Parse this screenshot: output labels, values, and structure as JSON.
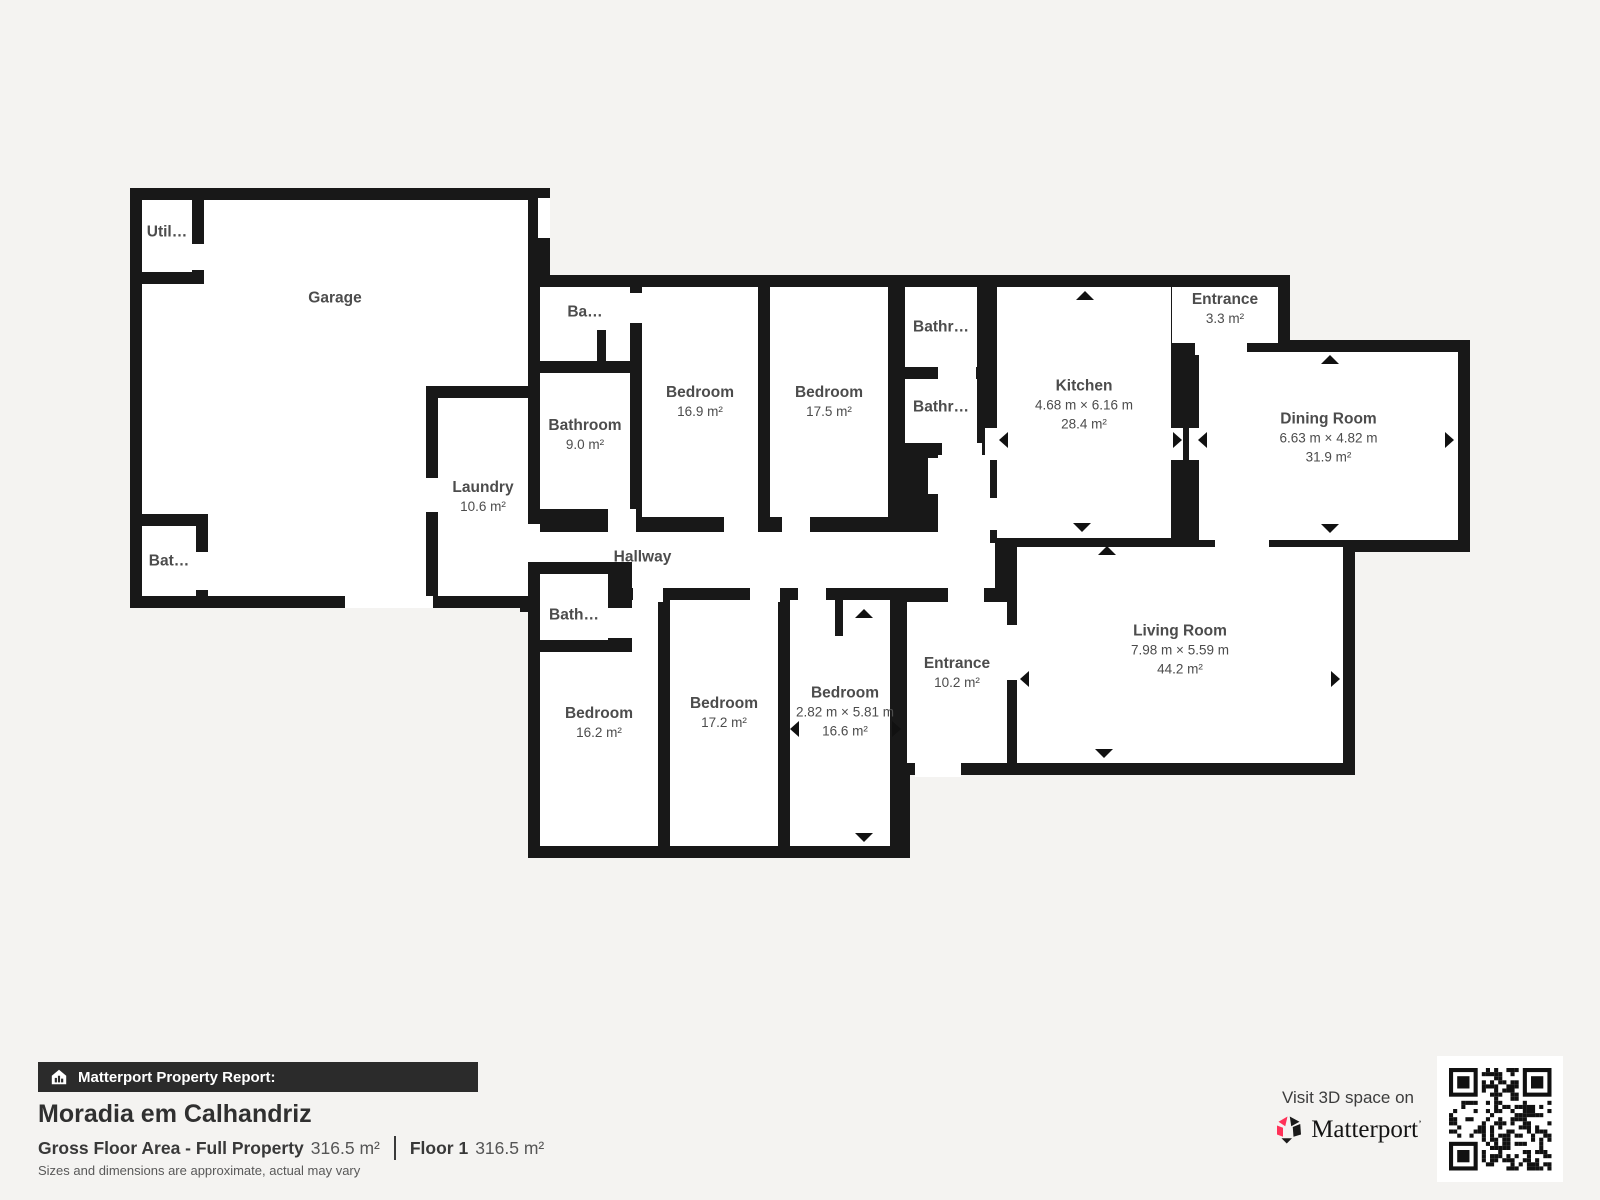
{
  "report": {
    "banner": "Matterport Property Report:",
    "property_name": "Moradia em Calhandriz",
    "gross_label": "Gross Floor Area - Full Property",
    "gross_value": "316.5 m²",
    "floor_label": "Floor 1",
    "floor_value": "316.5 m²",
    "disclaimer": "Sizes and dimensions are approximate, actual may vary"
  },
  "promo": {
    "visit_text": "Visit 3D space on",
    "brand": "Matterport",
    "trademark": "’"
  },
  "colors": {
    "wall": "#181818",
    "background": "#f4f3f1",
    "room": "#ffffff",
    "label": "#4c4c4c",
    "brand_red": "#ff3158",
    "banner_bg": "#2b2b2b"
  },
  "floorplan": {
    "cells": [
      {
        "t": "wall",
        "x": 130,
        "y": 188,
        "w": 420,
        "h": 420
      },
      {
        "t": "wall",
        "x": 528,
        "y": 275,
        "w": 382,
        "h": 270
      },
      {
        "t": "wall",
        "x": 893,
        "y": 275,
        "w": 92,
        "h": 180
      },
      {
        "t": "wall",
        "x": 893,
        "y": 443,
        "w": 100,
        "h": 100
      },
      {
        "t": "wall",
        "x": 985,
        "y": 275,
        "w": 200,
        "h": 275
      },
      {
        "t": "wall",
        "x": 1160,
        "y": 275,
        "w": 130,
        "h": 80
      },
      {
        "t": "wall",
        "x": 1181,
        "y": 350,
        "w": 20,
        "h": 202
      },
      {
        "t": "wall",
        "x": 1185,
        "y": 340,
        "w": 285,
        "h": 212
      },
      {
        "t": "wall",
        "x": 995,
        "y": 532,
        "w": 22,
        "h": 80
      },
      {
        "t": "wall",
        "x": 1005,
        "y": 535,
        "w": 350,
        "h": 240
      },
      {
        "t": "wall",
        "x": 895,
        "y": 590,
        "w": 130,
        "h": 185
      },
      {
        "t": "wall",
        "x": 520,
        "y": 520,
        "w": 475,
        "h": 92
      },
      {
        "t": "wall",
        "x": 528,
        "y": 588,
        "w": 382,
        "h": 270
      },
      {
        "t": "room",
        "x": 142,
        "y": 200,
        "w": 386,
        "h": 396,
        "label": {
          "name": "Garage",
          "dy": -100
        }
      },
      {
        "t": "wall",
        "x": 130,
        "y": 188,
        "w": 74,
        "h": 96
      },
      {
        "t": "room",
        "x": 142,
        "y": 200,
        "w": 50,
        "h": 72,
        "label": {
          "name": "Util…",
          "dy": -4
        }
      },
      {
        "t": "wall",
        "x": 130,
        "y": 514,
        "w": 78,
        "h": 94
      },
      {
        "t": "room",
        "x": 142,
        "y": 526,
        "w": 54,
        "h": 70,
        "label": {
          "name": "Bat…"
        }
      },
      {
        "t": "wall",
        "x": 426,
        "y": 386,
        "w": 114,
        "h": 222
      },
      {
        "t": "room",
        "x": 438,
        "y": 398,
        "w": 90,
        "h": 198,
        "label": {
          "name": "Laundry",
          "area": "10.6 m²"
        }
      },
      {
        "t": "room",
        "x": 540,
        "y": 287,
        "w": 90,
        "h": 74,
        "label": {
          "name": "Ba…",
          "dy": -12
        }
      },
      {
        "t": "wall",
        "x": 597,
        "y": 330,
        "w": 9,
        "h": 31
      },
      {
        "t": "room",
        "x": 540,
        "y": 373,
        "w": 90,
        "h": 136,
        "label": {
          "name": "Bathroom",
          "area": "9.0 m²",
          "dy": -6
        }
      },
      {
        "t": "room",
        "x": 642,
        "y": 287,
        "w": 116,
        "h": 230,
        "label": {
          "name": "Bedroom",
          "area": "16.9 m²"
        }
      },
      {
        "t": "room",
        "x": 770,
        "y": 287,
        "w": 118,
        "h": 230,
        "label": {
          "name": "Bedroom",
          "area": "17.5 m²"
        }
      },
      {
        "t": "room",
        "x": 905,
        "y": 287,
        "w": 72,
        "h": 80,
        "label": {
          "name": "Bathr…"
        }
      },
      {
        "t": "room",
        "x": 905,
        "y": 379,
        "w": 72,
        "h": 64,
        "label": {
          "name": "Bathr…",
          "dy": -4
        }
      },
      {
        "t": "room",
        "x": 938,
        "y": 455,
        "w": 52,
        "h": 88
      },
      {
        "t": "room",
        "x": 997,
        "y": 287,
        "w": 174,
        "h": 251,
        "label": {
          "name": "Kitchen",
          "dims": "4.68 m × 6.16 m",
          "area": "28.4 m²",
          "dy": -8
        }
      },
      {
        "t": "room",
        "x": 1172,
        "y": 287,
        "w": 106,
        "h": 56,
        "label": {
          "name": "Entrance",
          "area": "3.3 m²",
          "dy": -6
        }
      },
      {
        "t": "room",
        "x": 1199,
        "y": 352,
        "w": 259,
        "h": 188,
        "label": {
          "name": "Dining Room",
          "dims": "6.63 m × 4.82 m",
          "area": "31.9 m²",
          "dy": -8
        }
      },
      {
        "t": "room",
        "x": 1017,
        "y": 547,
        "w": 326,
        "h": 216,
        "label": {
          "name": "Living Room",
          "dims": "7.98 m × 5.59 m",
          "area": "44.2 m²",
          "dy": -5
        }
      },
      {
        "t": "room",
        "x": 540,
        "y": 532,
        "w": 437,
        "h": 56,
        "label": {
          "name": "Hallway",
          "dx": -116,
          "dy": -3
        }
      },
      {
        "t": "room",
        "x": 935,
        "y": 543,
        "w": 60,
        "h": 45
      },
      {
        "t": "room",
        "x": 540,
        "y": 600,
        "w": 118,
        "h": 246,
        "label": {
          "name": "Bedroom",
          "area": "16.2 m²"
        }
      },
      {
        "t": "room",
        "x": 670,
        "y": 600,
        "w": 108,
        "h": 246,
        "label": {
          "name": "Bedroom",
          "area": "17.2 m²",
          "dy": -10
        }
      },
      {
        "t": "room",
        "x": 790,
        "y": 600,
        "w": 100,
        "h": 246,
        "label": {
          "name": "Bedroom",
          "dims": "2.82 m × 5.81 m",
          "area": "16.6 m²",
          "dx": 5,
          "dy": -11
        }
      },
      {
        "t": "wall",
        "x": 835,
        "y": 600,
        "w": 8,
        "h": 36
      },
      {
        "t": "room",
        "x": 907,
        "y": 602,
        "w": 100,
        "h": 161,
        "label": {
          "name": "Entrance",
          "area": "10.2 m²",
          "dy": -10
        }
      },
      {
        "t": "wall",
        "x": 528,
        "y": 562,
        "w": 104,
        "h": 90
      },
      {
        "t": "room",
        "x": 540,
        "y": 574,
        "w": 68,
        "h": 66,
        "label": {
          "name": "Bath…",
          "dy": 8
        }
      }
    ],
    "openings": [
      [
        192,
        244,
        12,
        26
      ],
      [
        538,
        198,
        12,
        40
      ],
      [
        196,
        552,
        12,
        38
      ],
      [
        426,
        478,
        12,
        34
      ],
      [
        345,
        596,
        88,
        12
      ],
      [
        528,
        524,
        12,
        38
      ],
      [
        630,
        293,
        12,
        30
      ],
      [
        608,
        509,
        28,
        24
      ],
      [
        724,
        517,
        34,
        17
      ],
      [
        782,
        517,
        28,
        17
      ],
      [
        938,
        367,
        38,
        12
      ],
      [
        942,
        443,
        40,
        12
      ],
      [
        928,
        458,
        12,
        36
      ],
      [
        985,
        428,
        12,
        32
      ],
      [
        985,
        498,
        12,
        32
      ],
      [
        1171,
        428,
        12,
        32
      ],
      [
        1189,
        428,
        12,
        32
      ],
      [
        1195,
        343,
        52,
        12
      ],
      [
        1215,
        536,
        54,
        18
      ],
      [
        1007,
        625,
        10,
        55
      ],
      [
        948,
        584,
        36,
        20
      ],
      [
        915,
        763,
        46,
        14
      ],
      [
        633,
        584,
        30,
        18
      ],
      [
        750,
        584,
        30,
        18
      ],
      [
        798,
        584,
        28,
        18
      ],
      [
        608,
        608,
        26,
        30
      ]
    ],
    "arrows": [
      [
        1085,
        296,
        "up"
      ],
      [
        1082,
        528,
        "down"
      ],
      [
        1004,
        440,
        "left"
      ],
      [
        1178,
        440,
        "right"
      ],
      [
        1203,
        440,
        "left"
      ],
      [
        1330,
        360,
        "up"
      ],
      [
        1330,
        529,
        "down"
      ],
      [
        1450,
        440,
        "right"
      ],
      [
        1107,
        551,
        "up"
      ],
      [
        1025,
        679,
        "left"
      ],
      [
        1336,
        679,
        "right"
      ],
      [
        1104,
        754,
        "down"
      ],
      [
        795,
        729,
        "left"
      ],
      [
        897,
        729,
        "right"
      ],
      [
        864,
        614,
        "up"
      ],
      [
        864,
        838,
        "down"
      ]
    ]
  }
}
